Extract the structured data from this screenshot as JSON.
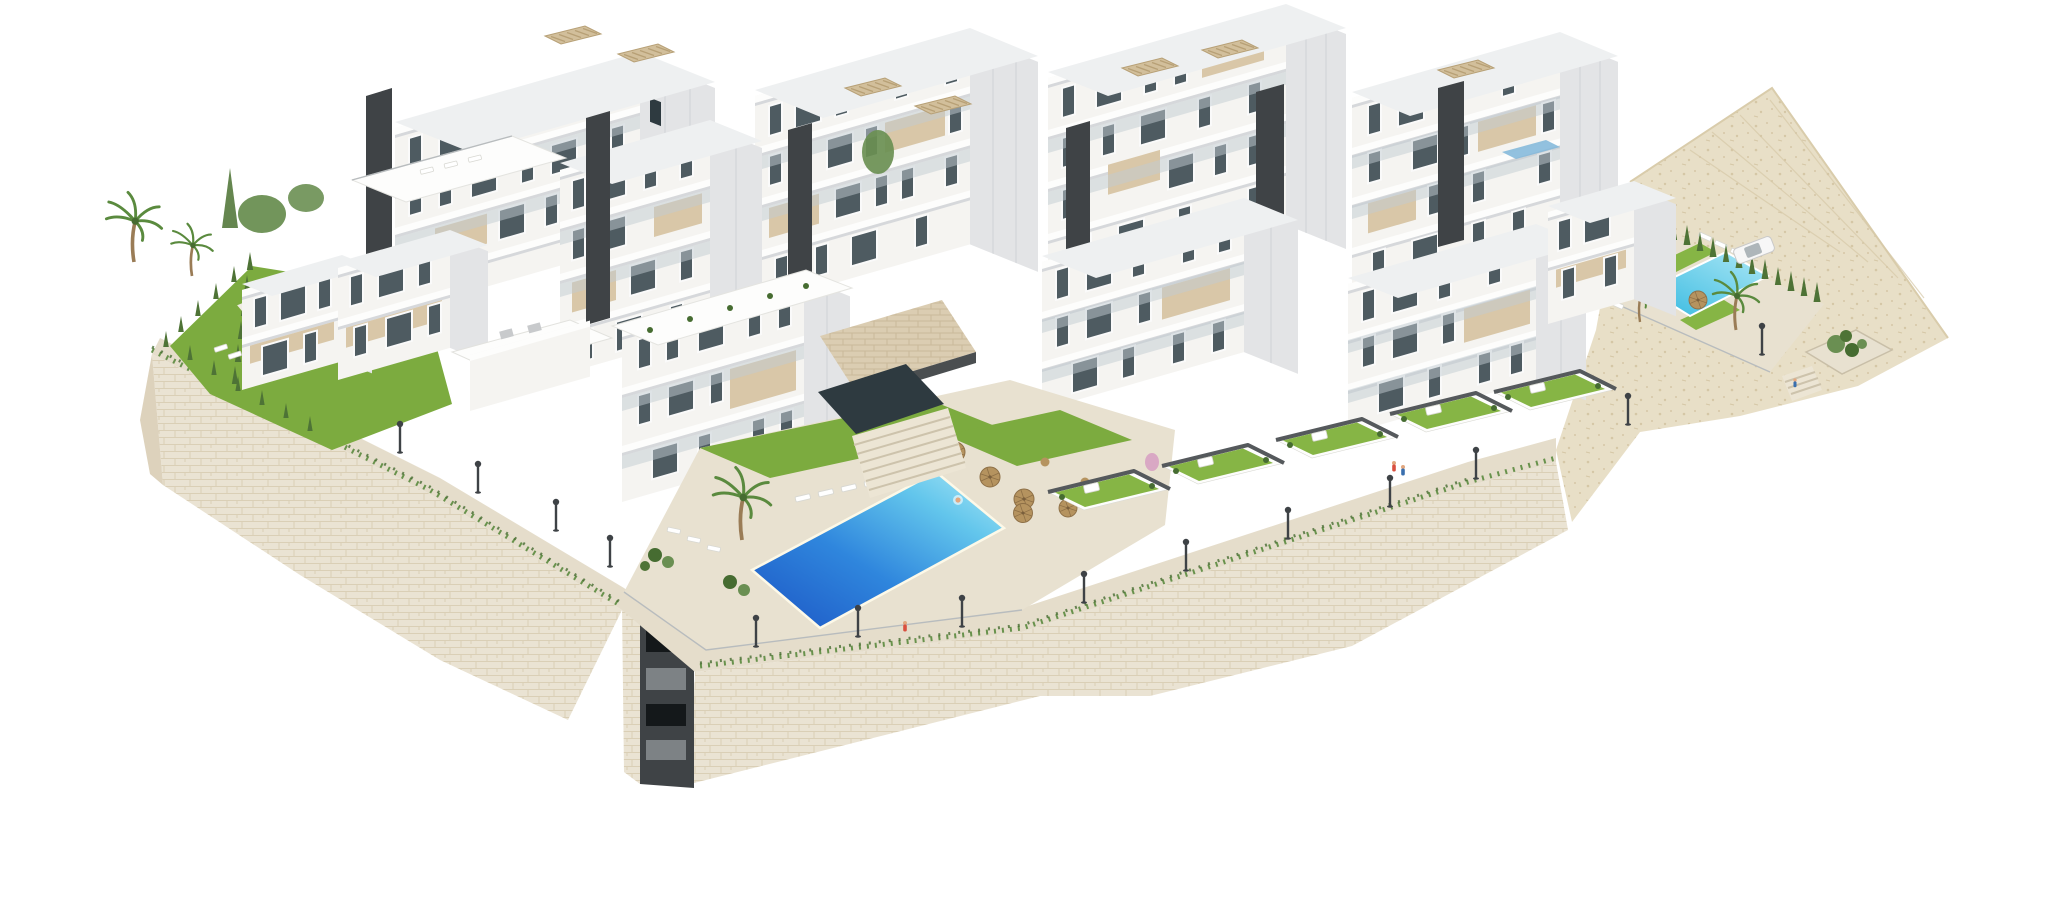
{
  "page": {
    "background": "#ffffff",
    "description": "Aerial axonometric 3D architectural rendering of a terraced white residential complex on a hillside: stepped apartment blocks with beige balconies and dark stair cores, rooftop pergolas, a large central community pool, a second pool on a sandy plot to the right, a small private plunge pool on the left lawn, private garden terraces, palm trees, cypress hedges, street lamps, and a massive beige stone retaining wall, isolated on a pure white background."
  },
  "palette": {
    "white-face": "#f5f4f1",
    "white-bright": "#fdfdfc",
    "side-shade": "#e3e4e6",
    "side-deep": "#d6d8db",
    "roof-top": "#eef0f1",
    "beige": "#d9c7a8",
    "beige-dark": "#c4ae8a",
    "pergola": "#d2bf9b",
    "core-dark": "#3f4346",
    "glass": "#4e5b61",
    "glass-dark": "#2e3a40",
    "balustrade": "#c2ccd1",
    "lawn": "#7cab3f",
    "lawn-bright": "#86b545",
    "hedge": "#466c31",
    "cypress": "#4e7336",
    "tree": "#6a8f52",
    "palm": "#5a8a3e",
    "pool-deep": "#1c55c4",
    "pool-mid": "#2f86dd",
    "pool-light": "#63c6ec",
    "pool-pale": "#aee8f6",
    "pool-small": "#35b9e0",
    "deck": "#e8e1d0",
    "promenade": "#e5ddcb",
    "wall-base": "#eae3d3",
    "wall-joint": "#d7cbb2",
    "wall-shade": "#ddd2bc",
    "sand": "#e8dfc7",
    "sand-dot": "#d5c7a6",
    "stair": "#ece5d4",
    "stair-line": "#cdc3ac",
    "cap-gray": "#55595c",
    "lamp": "#3e4246",
    "parasol": "#b5935f",
    "car-body": "#f7f7f7",
    "skin": "#e2a77f",
    "accent-red": "#d94f3f",
    "accent-blue": "#3a6fae",
    "roof-glass": "#7fb6d9"
  },
  "scene": {
    "style": "architectural-visualization",
    "camera": "high oblique axonometric",
    "objects": [
      {
        "name": "apartment-cluster",
        "count": 5,
        "notes": "white stepped blocks, beige balcony panels, charcoal stair cores, rooftop pergolas"
      },
      {
        "name": "community-pool-central",
        "color_ref": "pool-deep",
        "shape": "slanted rectangle"
      },
      {
        "name": "community-pool-right",
        "color_ref": "pool-light"
      },
      {
        "name": "private-plunge-pool-left",
        "color_ref": "pool-small"
      },
      {
        "name": "private-garden-terrace",
        "count": 5
      },
      {
        "name": "left-lawn-garden",
        "count": 1
      },
      {
        "name": "stone-retaining-wall",
        "count": 2,
        "color_ref": "wall-base"
      },
      {
        "name": "elevator-shaft",
        "count": 1,
        "color_ref": "core-dark"
      },
      {
        "name": "entrance-stairs",
        "count": 2
      },
      {
        "name": "sand-terrain-right",
        "color_ref": "sand"
      },
      {
        "name": "palm-tree",
        "count": 5
      },
      {
        "name": "cypress-hedge-row",
        "count": 3
      },
      {
        "name": "street-lamp",
        "count": 14
      },
      {
        "name": "sun-lounger",
        "count": 18
      },
      {
        "name": "wicker-parasol",
        "count": 6
      },
      {
        "name": "white-suv-car",
        "count": 1,
        "color_ref": "car-body"
      },
      {
        "name": "person",
        "count": 5
      }
    ]
  }
}
